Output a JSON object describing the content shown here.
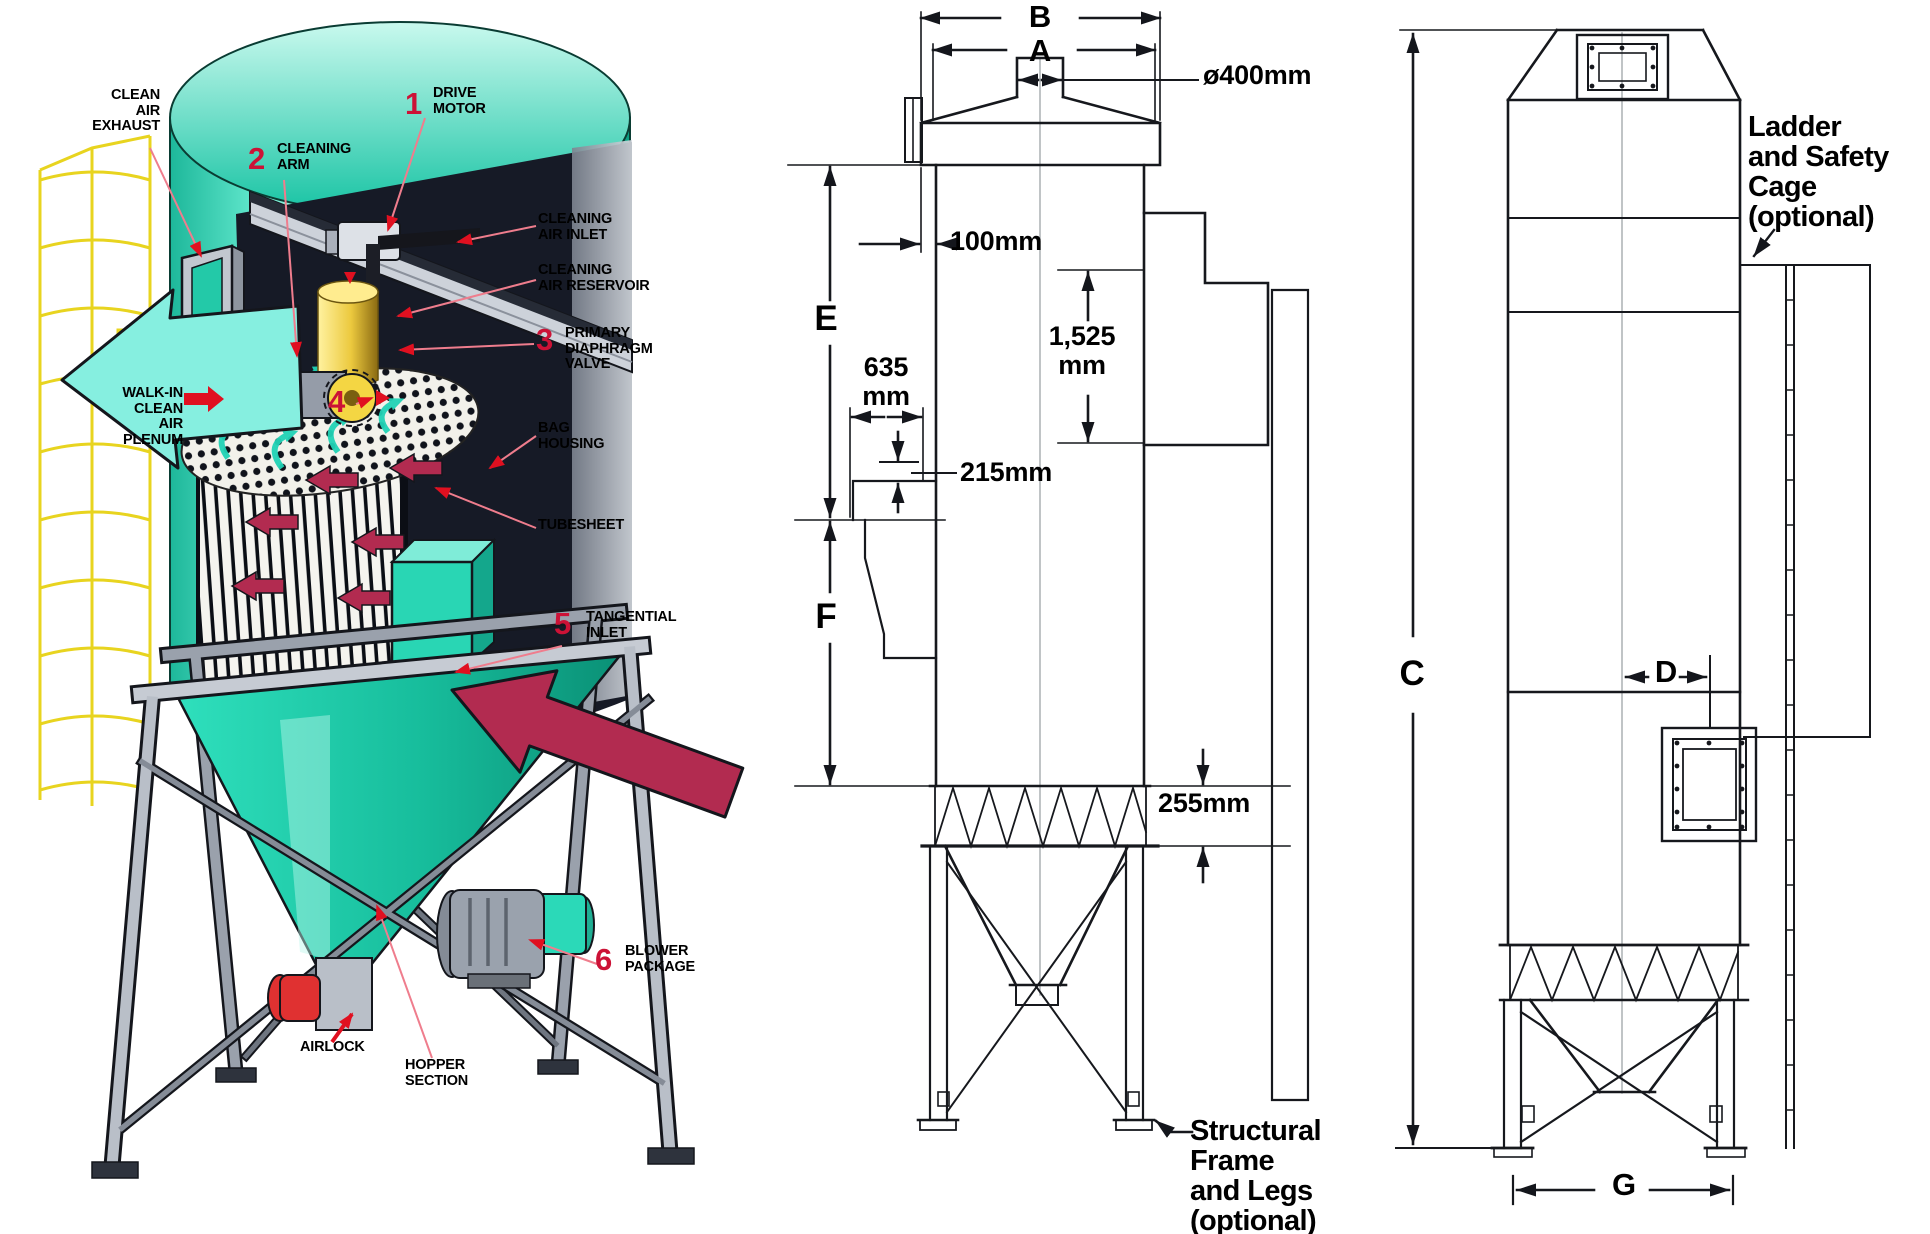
{
  "cutaway": {
    "callouts": [
      {
        "num": "1",
        "label": "DRIVE\nMOTOR"
      },
      {
        "num": "2",
        "label": "CLEANING\nARM"
      },
      {
        "num": "3",
        "label": "PRIMARY\nDIAPHRAGM\nVALVE"
      },
      {
        "num": "4",
        "label": ""
      },
      {
        "num": "5",
        "label": "TANGENTIAL\nINLET"
      },
      {
        "num": "6",
        "label": "BLOWER\nPACKAGE"
      }
    ],
    "labels": {
      "clean_air_exhaust": "CLEAN\nAIR\nEXHAUST",
      "cleaning_air_inlet": "CLEANING\nAIR INLET",
      "cleaning_air_reservoir": "CLEANING\nAIR RESERVOIR",
      "walk_in_plenum": "WALK-IN\nCLEAN\nAIR\nPLENUM",
      "bag_housing": "BAG\nHOUSING",
      "tubesheet": "TUBESHEET",
      "airlock": "AIRLOCK",
      "hopper_section": "HOPPER\nSECTION"
    }
  },
  "side_view": {
    "dim_letters": {
      "a": "A",
      "b": "B",
      "e": "E",
      "f": "F"
    },
    "measurements": {
      "outlet_diameter": "ø400mm",
      "top_offset": "100mm",
      "inlet_duct_height": "1,525\nmm",
      "scroll_width": "635\nmm",
      "flange_gap": "215mm",
      "base_ring_height": "255mm"
    },
    "note_structural": "Structural\nFrame\nand Legs\n(optional)"
  },
  "front_view": {
    "dim_letters": {
      "c": "C",
      "d": "D",
      "g": "G"
    },
    "note_ladder": "Ladder\nand Safety\nCage\n(optional)"
  },
  "colors": {
    "accent_red": "#cc1236",
    "leader_pink": "#ef7d8d",
    "teal": "#2bd9b8",
    "cage_yellow": "#e8d41f",
    "inlet_maroon": "#b22b50"
  }
}
